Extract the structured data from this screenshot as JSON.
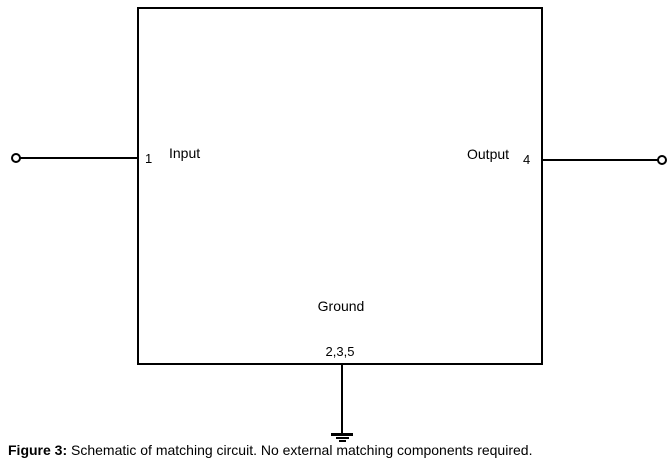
{
  "schematic": {
    "input_label": "Input",
    "input_pin": "1",
    "output_label": "Output",
    "output_pin": "4",
    "ground_label": "Ground",
    "ground_pins": "2,3,5"
  },
  "figure": {
    "caption_label": "Figure 3:",
    "caption_text": " Schematic of matching circuit. No external matching components required."
  },
  "colors": {
    "line": "#000000",
    "background": "#ffffff"
  }
}
